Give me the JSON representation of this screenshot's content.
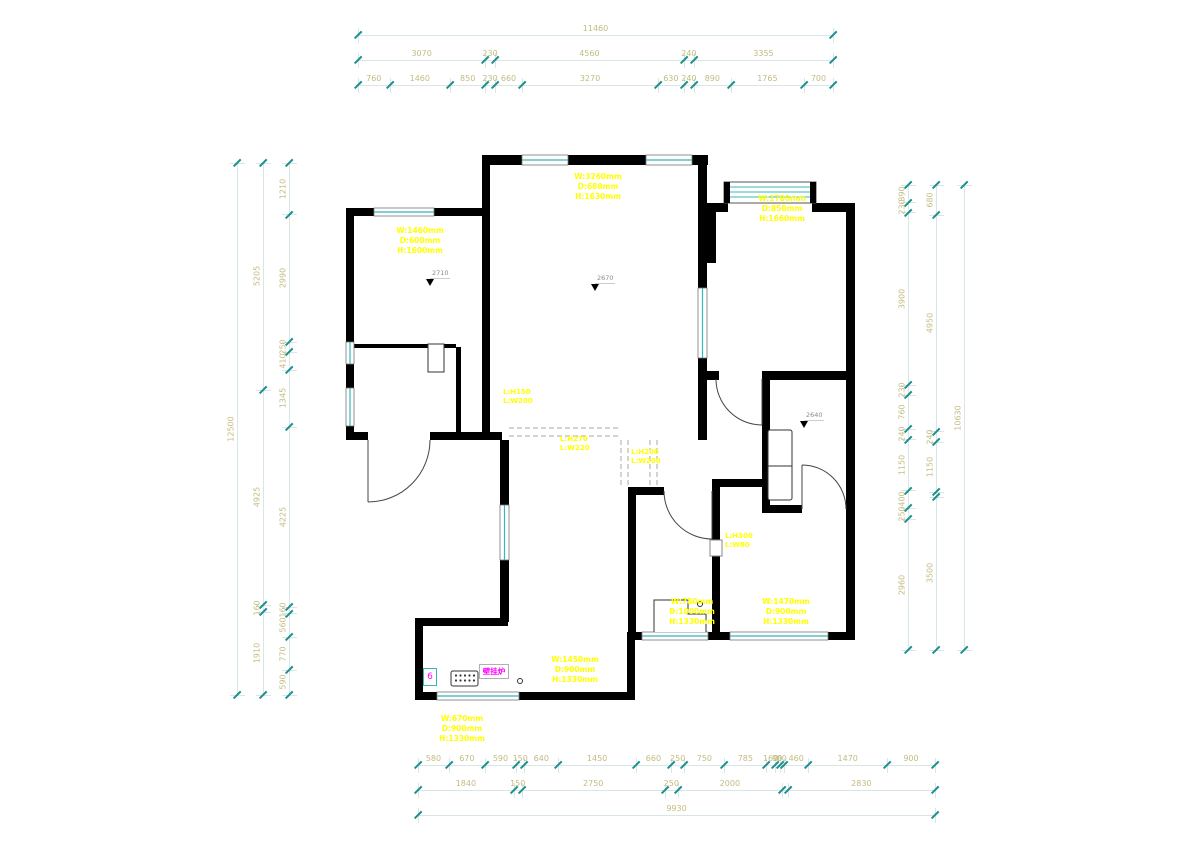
{
  "colors": {
    "wall": "#000000",
    "window": "#35b8b8",
    "dim_text": "#c3bb80",
    "dim_line": "#d9e6e6",
    "tick": "#1e8f8f",
    "annotation": "#ffff00",
    "magenta": "#ff00ff",
    "dashed": "#a8a8a8"
  },
  "chains": [
    {
      "id": "top-total",
      "dir": "h",
      "x": 358,
      "y": 35,
      "len": 475,
      "segs": [
        [
          "11460",
          11460
        ]
      ]
    },
    {
      "id": "top-mid",
      "dir": "h",
      "x": 358,
      "y": 60,
      "len": 475,
      "segs": [
        [
          "3070",
          3070
        ],
        [
          "230",
          230
        ],
        [
          "4560",
          4560
        ],
        [
          "240",
          240
        ],
        [
          "3355",
          3355
        ]
      ]
    },
    {
      "id": "top-detail",
      "dir": "h",
      "x": 358,
      "y": 85,
      "len": 475,
      "segs": [
        [
          "760",
          760
        ],
        [
          "1460",
          1460
        ],
        [
          "850",
          850
        ],
        [
          "230",
          230
        ],
        [
          "660",
          660
        ],
        [
          "3270",
          3270
        ],
        [
          "630",
          630
        ],
        [
          "240",
          240
        ],
        [
          "890",
          890
        ],
        [
          "1765",
          1765
        ],
        [
          "700",
          700
        ]
      ]
    },
    {
      "id": "bottom-detail",
      "dir": "h",
      "x": 418,
      "y": 765,
      "len": 517,
      "segs": [
        [
          "580",
          580
        ],
        [
          "670",
          670
        ],
        [
          "590",
          590
        ],
        [
          "150",
          150
        ],
        [
          "640",
          640
        ],
        [
          "1450",
          1450
        ],
        [
          "660",
          660
        ],
        [
          "250",
          250
        ],
        [
          "750",
          750
        ],
        [
          "785",
          785
        ],
        [
          "160",
          160
        ],
        [
          "90",
          90
        ],
        [
          "80",
          80
        ],
        [
          "460",
          460
        ],
        [
          "1470",
          1470
        ],
        [
          "900",
          900
        ]
      ]
    },
    {
      "id": "bottom-mid",
      "dir": "h",
      "x": 418,
      "y": 790,
      "len": 517,
      "segs": [
        [
          "1840",
          1840
        ],
        [
          "150",
          150
        ],
        [
          "2750",
          2750
        ],
        [
          "250",
          250
        ],
        [
          "2000",
          2000
        ],
        [
          "",
          110
        ],
        [
          "2830",
          2830
        ]
      ]
    },
    {
      "id": "bottom-total",
      "dir": "h",
      "x": 418,
      "y": 815,
      "len": 517,
      "segs": [
        [
          "9930",
          9930
        ]
      ]
    },
    {
      "id": "left-total",
      "dir": "v",
      "x": 237,
      "y": 163,
      "len": 532,
      "segs": [
        [
          "12500",
          12500
        ]
      ]
    },
    {
      "id": "left-mid",
      "dir": "v",
      "x": 263,
      "y": 163,
      "len": 532,
      "segs": [
        [
          "5205",
          5205
        ],
        [
          "4925",
          4925
        ],
        [
          "160",
          160
        ],
        [
          "1910",
          1910
        ]
      ]
    },
    {
      "id": "left-detail",
      "dir": "v",
      "x": 289,
      "y": 163,
      "len": 532,
      "segs": [
        [
          "1210",
          1210
        ],
        [
          "2990",
          2990
        ],
        [
          "250",
          250
        ],
        [
          "410",
          410
        ],
        [
          "1345",
          1345
        ],
        [
          "4225",
          4225
        ],
        [
          "160",
          160
        ],
        [
          "560",
          560
        ],
        [
          "770",
          770
        ],
        [
          "590",
          590
        ]
      ]
    },
    {
      "id": "right-detail",
      "dir": "v",
      "x": 908,
      "y": 185,
      "len": 465,
      "segs": [
        [
          "390",
          390
        ],
        [
          "230",
          230
        ],
        [
          "3900",
          3900
        ],
        [
          "230",
          230
        ],
        [
          "760",
          760
        ],
        [
          "240",
          240
        ],
        [
          "1150",
          1150
        ],
        [
          "400",
          400
        ],
        [
          "250",
          250
        ],
        [
          "2960",
          2960
        ]
      ]
    },
    {
      "id": "right-mid",
      "dir": "v",
      "x": 936,
      "y": 185,
      "len": 465,
      "segs": [
        [
          "680",
          680
        ],
        [
          "4950",
          4950
        ],
        [
          "240",
          240
        ],
        [
          "1150",
          1150
        ],
        [
          "",
          110
        ],
        [
          "3500",
          3500
        ]
      ]
    },
    {
      "id": "right-total",
      "dir": "v",
      "x": 964,
      "y": 185,
      "len": 465,
      "segs": [
        [
          "10630",
          10630
        ]
      ]
    }
  ],
  "window_annotations": [
    {
      "id": "bedroom1",
      "x": 420,
      "y": 226,
      "lines": [
        "W:1460mm",
        "D:600mm",
        "H:1600mm"
      ]
    },
    {
      "id": "living",
      "x": 598,
      "y": 172,
      "lines": [
        "W:3260mm",
        "D:680mm",
        "H:1630mm"
      ]
    },
    {
      "id": "room-top-right",
      "x": 782,
      "y": 194,
      "lines": [
        "W:1780mm",
        "D:850mm",
        "H:1660mm"
      ]
    },
    {
      "id": "kitchen",
      "x": 575,
      "y": 655,
      "lines": [
        "W:1450mm",
        "D:900mm",
        "H:1330mm"
      ]
    },
    {
      "id": "kitchen-left",
      "x": 462,
      "y": 714,
      "lines": [
        "W:670mm",
        "D:900mm",
        "H:1330mm"
      ]
    },
    {
      "id": "bedroom2",
      "x": 692,
      "y": 597,
      "lines": [
        "W:780mm",
        "D:1000mm",
        "H:1330mm"
      ]
    },
    {
      "id": "bedroom3",
      "x": 786,
      "y": 597,
      "lines": [
        "W:1470mm",
        "D:900mm",
        "H:1330mm"
      ]
    }
  ],
  "lintel_labels": [
    {
      "id": "lintel-1",
      "x": 503,
      "y": 388,
      "lines": [
        "L:H150",
        "L:W200"
      ]
    },
    {
      "id": "lintel-2",
      "x": 560,
      "y": 435,
      "lines": [
        "L:H270",
        "L:W220"
      ]
    },
    {
      "id": "lintel-3",
      "x": 631,
      "y": 448,
      "lines": [
        "L:H200",
        "L:W200"
      ]
    },
    {
      "id": "lintel-4",
      "x": 725,
      "y": 532,
      "lines": [
        "L:H300",
        "L:W80"
      ]
    }
  ],
  "elevation_markers": [
    {
      "id": "elev-1",
      "x": 432,
      "y": 269,
      "value": "2710"
    },
    {
      "id": "elev-2",
      "x": 597,
      "y": 274,
      "value": "2670"
    },
    {
      "id": "elev-3",
      "x": 806,
      "y": 411,
      "value": "2640"
    }
  ],
  "appliances": {
    "gas_box": "6",
    "boiler": "壁挂炉"
  }
}
